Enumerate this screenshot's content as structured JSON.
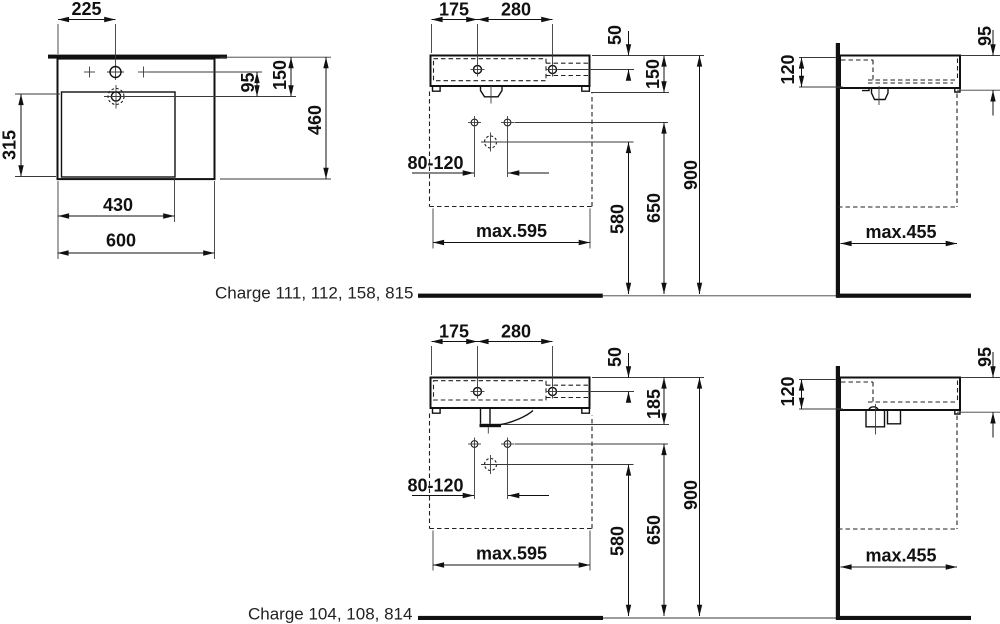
{
  "products": {
    "row1": {
      "label": "Charge 111, 112, 158, 815",
      "plan": {
        "tap_center_x": "225",
        "tap_to_drain": "95",
        "rim_to_drain": "150",
        "basin_depth": "315",
        "total_depth": "460",
        "basin_width": "430",
        "total_width": "600"
      },
      "front": {
        "edge_to_tap": "175",
        "tap_spacing": "280",
        "rim_to_tap": "50",
        "body_height": "150",
        "anchor_spacing": "80-120",
        "drain_height": "580",
        "anchor_height": "650",
        "rim_height": "900",
        "max_width": "max.595"
      },
      "side": {
        "front_height": "95",
        "back_height": "120",
        "max_depth": "max.455"
      }
    },
    "row2": {
      "label": "Charge 104, 108, 814",
      "front": {
        "edge_to_tap": "175",
        "tap_spacing": "280",
        "rim_to_tap": "50",
        "body_height": "185",
        "anchor_spacing": "80-120",
        "drain_height": "580",
        "anchor_height": "650",
        "rim_height": "900",
        "max_width": "max.595"
      },
      "side": {
        "front_height": "95",
        "back_height": "120",
        "max_depth": "max.455"
      }
    }
  }
}
